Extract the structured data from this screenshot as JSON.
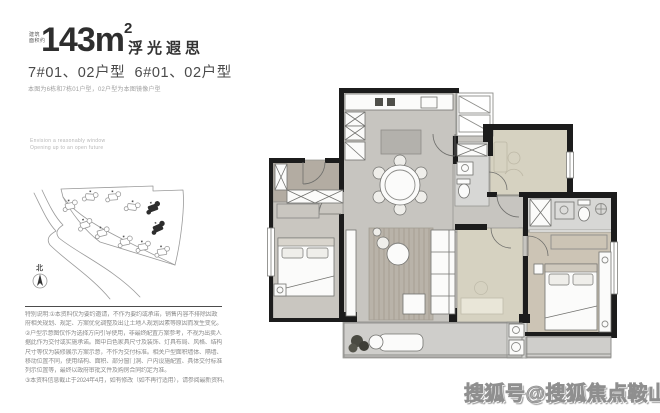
{
  "header": {
    "area_prefix_line1": "建筑",
    "area_prefix_line2": "面积约",
    "area_value": "143m",
    "area_sup": "2",
    "plan_name": "浮光遐思",
    "subtitle": "7#01、02户型  6#01、02户型",
    "mirror_note": "本图为6栋和7栋01户型，02户型为本图镜像户型"
  },
  "tagline": {
    "line1": "Envision a reasonably window",
    "line2": "Opening up to an open future"
  },
  "site_map": {
    "north_label": "北"
  },
  "disclaimer": {
    "lines": [
      "特别说明:①本资料仅为要约邀请，不作为要约或承诺，销售内容不排除因政",
      "府相关规划、规定、方案优化调整及出让土地人规划因素等原因而发生变化。",
      "②户型示意图仅作为选择方向引导使用，非最终配置方案参考，不视为出卖人",
      "据此作为交付或实施承诺。图中白色家具尺寸及装饰、灯具布局、风格、结构",
      "尺寸等仅为装修展示方案示意，不作为交付标准。相关户型面积墙体、隔墙、",
      "移动位置不同，使用结构、面积、部分窗门洞、户内设施配置、具体交付标准",
      "列示位置等，最终以政府审批文件及购房合同约定为准。",
      "③本资料信息截止于2024年4月，如有修改（如不再行适用），请参阅最新资料。"
    ]
  },
  "watermark": {
    "text": "搜狐号@搜狐焦点鞍山站"
  },
  "colors": {
    "wall": "#1c1c1c",
    "floorMain": "#c7c5c0",
    "floorEntry": "#b3aca2",
    "floorBedroomLeft": "#c9c6c0",
    "floorBeige": "#d6d2c1",
    "floorMaster": "#ccc4b5",
    "floorBath": "#d7d7d5",
    "floorBalcony": "#cfcecb",
    "rug": "#b9b3a9",
    "furnFill": "#fbfbfa",
    "furnStroke": "#737370",
    "sketchStroke": "#9a9a9a"
  }
}
